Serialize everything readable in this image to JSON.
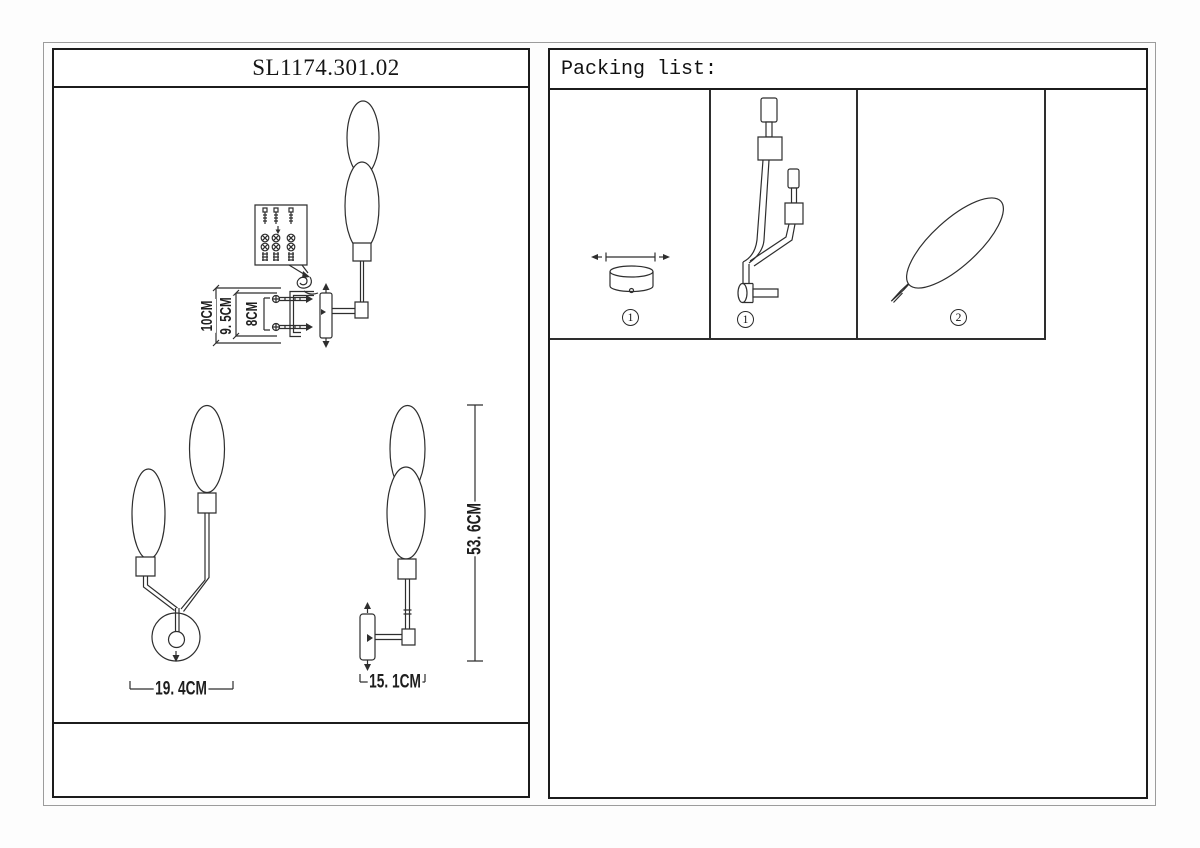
{
  "title": "SL1174.301.02",
  "packing": {
    "header": "Packing list:",
    "items": [
      {
        "qty": "1"
      },
      {
        "qty": "1"
      },
      {
        "qty": "2"
      }
    ]
  },
  "dimensions": {
    "mount_total": "10CM",
    "mount_mid": "9. 5CM",
    "mount_holes": "8CM",
    "front_width": "19. 4CM",
    "side_depth": "15. 1CM",
    "total_height": "53. 6CM"
  }
}
